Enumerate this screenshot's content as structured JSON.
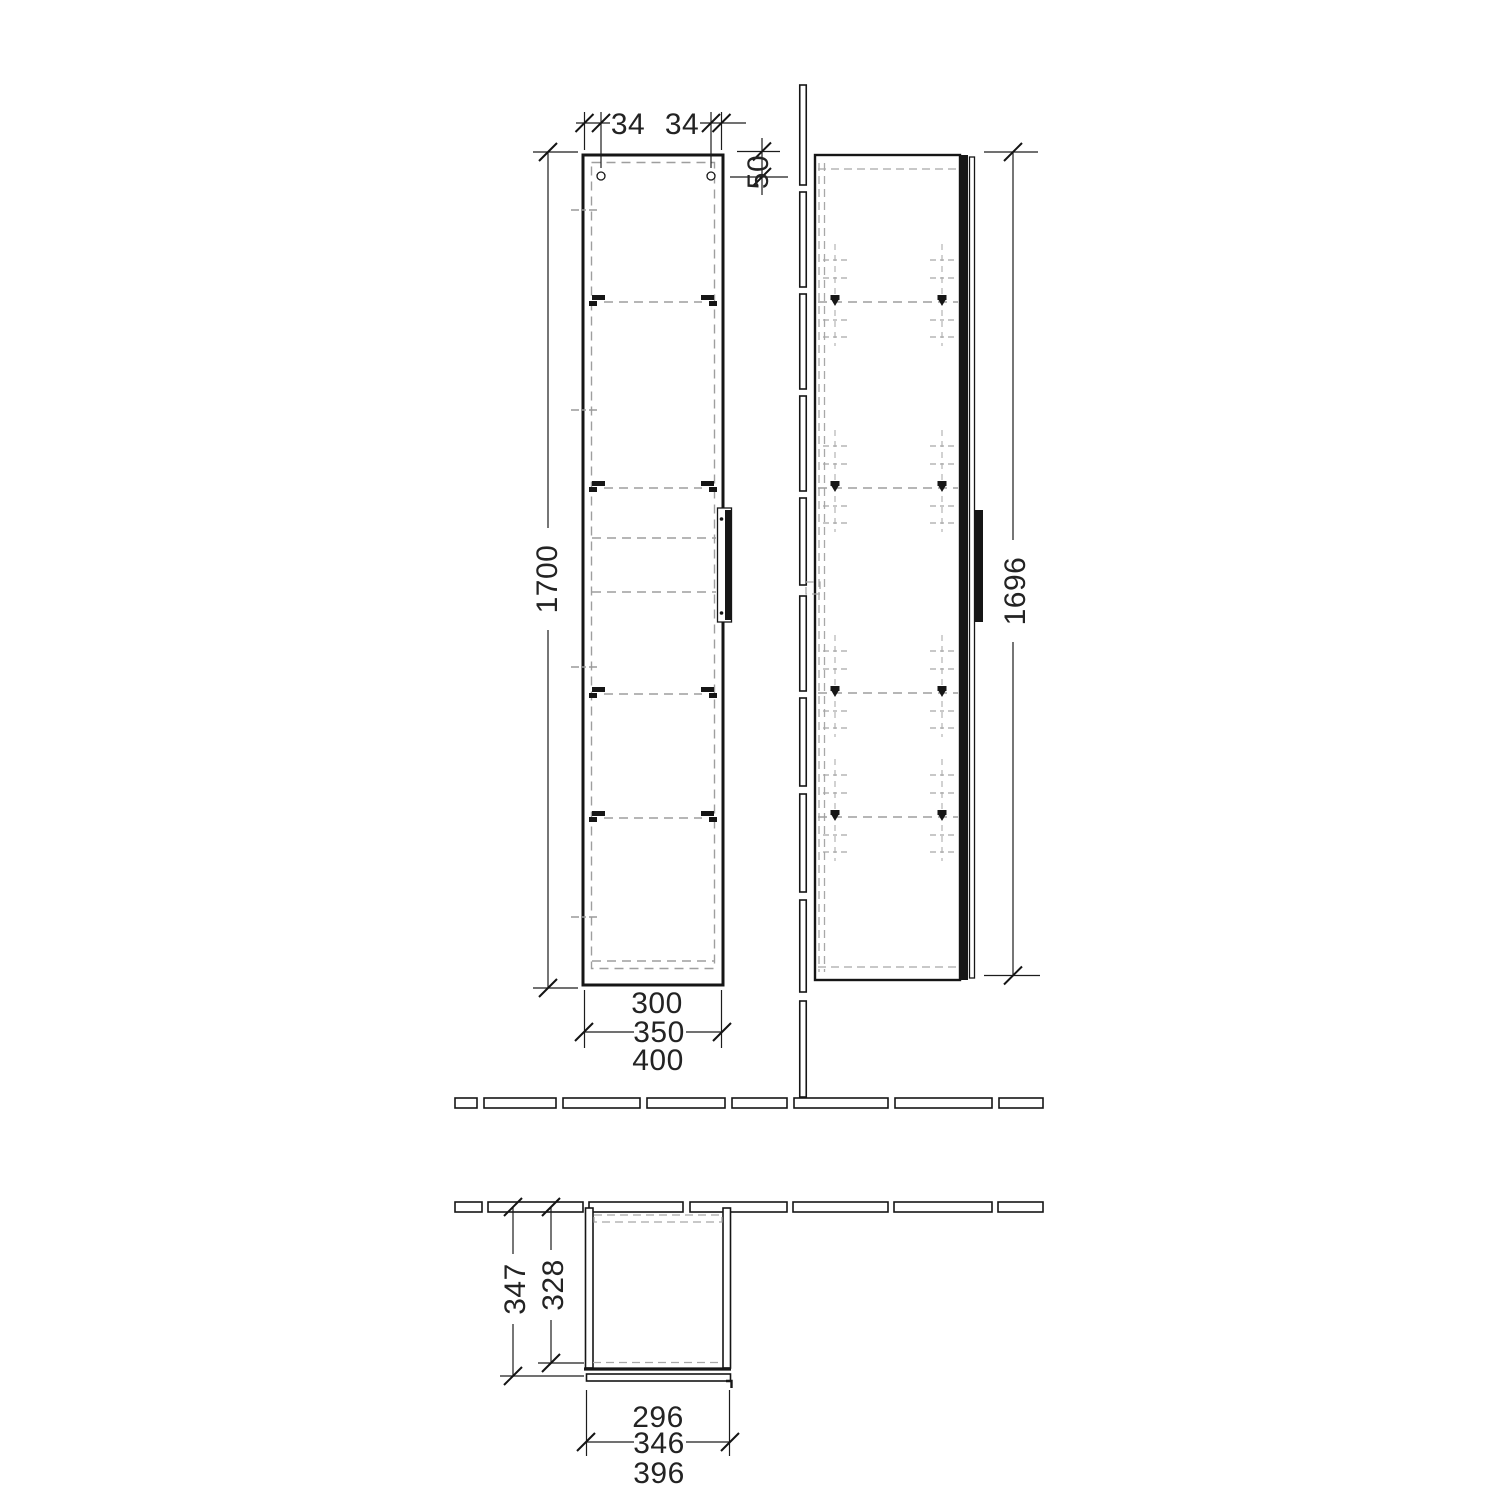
{
  "drawing": {
    "front": {
      "dim_hinge_left_mm": "34",
      "dim_hinge_right_mm": "34",
      "dim_top_offset_mm": "50",
      "dim_height_mm": "1700",
      "dim_width_small_mm": "300",
      "dim_width_mid_mm": "350",
      "dim_width_large_mm": "400"
    },
    "side": {
      "dim_door_height_mm": "1696"
    },
    "plan": {
      "dim_depth_total_mm": "347",
      "dim_depth_body_mm": "328",
      "dim_width_small_mm": "296",
      "dim_width_mid_mm": "346",
      "dim_width_large_mm": "396"
    }
  }
}
